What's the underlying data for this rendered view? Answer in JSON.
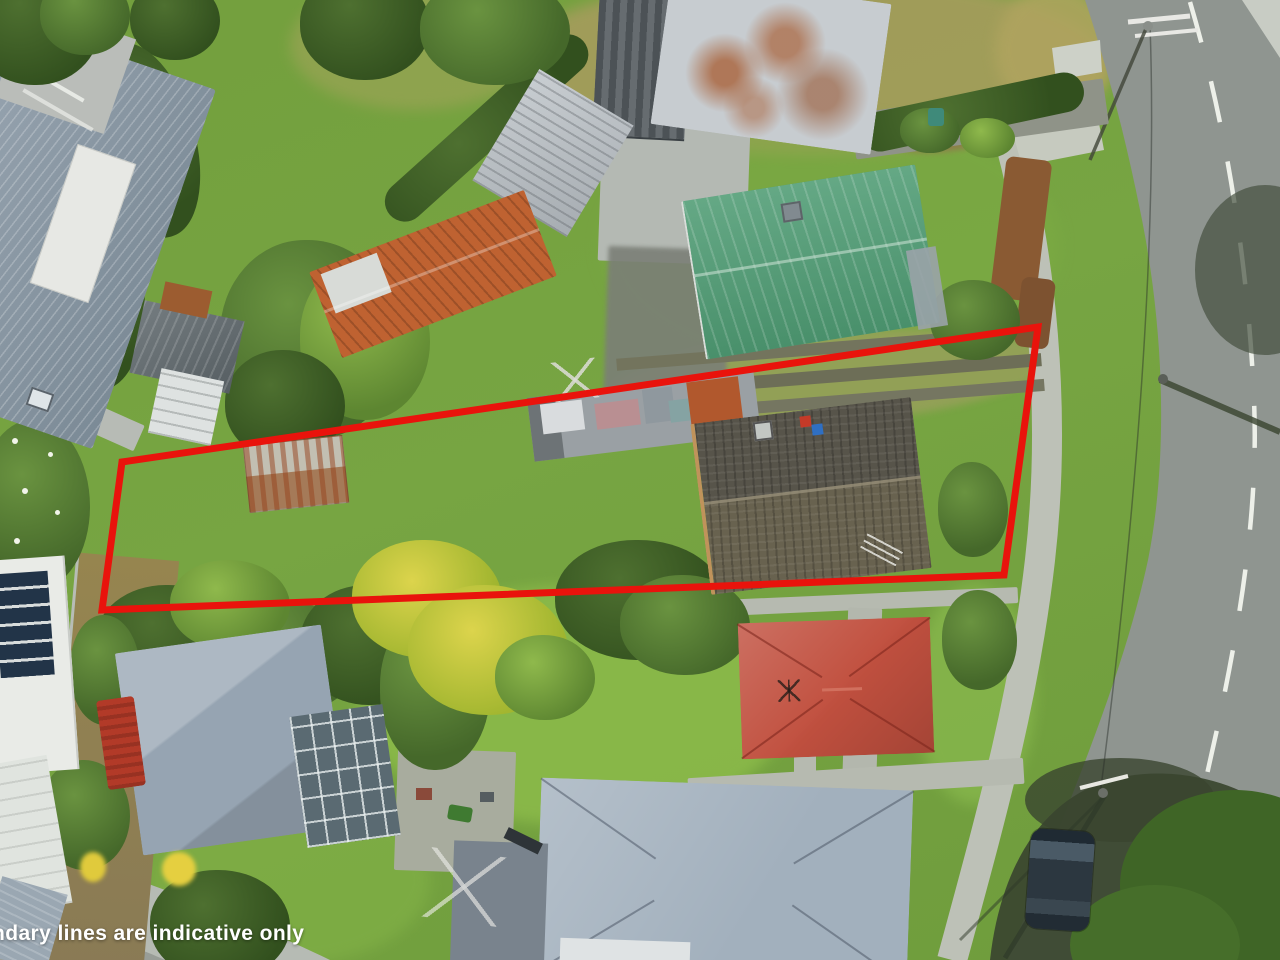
{
  "overlay": {
    "disclaimer": "Boundary lines are indicative only"
  },
  "boundary": {
    "color": "#e9130c",
    "stroke_width": "7",
    "points": "122,462 1038,327 1004,575 102,610"
  },
  "scene": {
    "description_items": {
      "road_marking": "dashed white centerline",
      "outlined_parcel": "long narrow overgrown section with shed, outbuilding and dark-roof house"
    },
    "colors": {
      "grass_base": "#76a33e",
      "grass_bright": "#8cbb4a",
      "grass_dry": "#a89c5e",
      "foliage_dark": "#3c5c24",
      "road_asphalt": "#8f9590",
      "concrete": "#bcc1b7",
      "roof_bluegray": "#93a1ad",
      "roof_teal": "#4f9c74",
      "roof_dark": "#5b574d",
      "roof_red": "#c1503f",
      "roof_steel": "#a2b0bd",
      "roof_white_rust": "#c7ccd0",
      "rust": "#a86434",
      "orange_roof": "#bf6231",
      "solar_panel": "#223448",
      "shadow_green": "#3a452f",
      "boundary_red": "#e9130c",
      "marking_white": "#f2f4ee",
      "car_body": "#2c3740",
      "dirt": "#8d7a52",
      "text_white": "#ffffff"
    }
  }
}
